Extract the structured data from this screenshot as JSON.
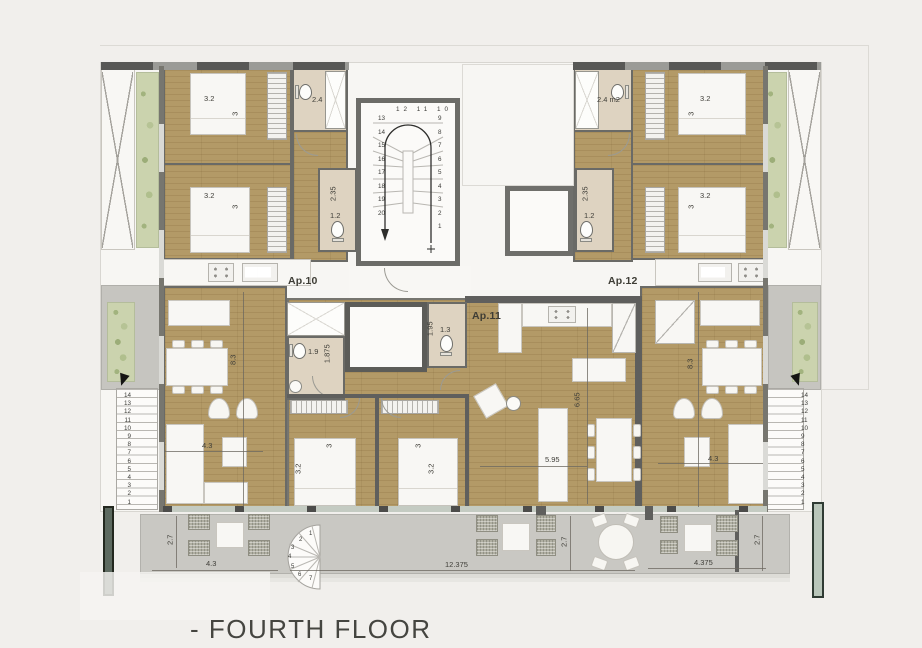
{
  "title": "- FOURTH FLOOR",
  "apartments": {
    "ap10": "Ap.10",
    "ap11": "Ap.11",
    "ap12": "Ap.12"
  },
  "dims": {
    "left_wing": {
      "bed1_w": "3.2",
      "bed1_d": "3",
      "bed2_w": "3.2",
      "bed2_d": "3",
      "bath": "2.4",
      "wc_w": "2.35",
      "wc_d": "1.2",
      "living_d": "8.3",
      "living_w": "4.3",
      "ensuite_w": "1.9",
      "ensuite_d": "1.875"
    },
    "center": {
      "wc_d": "1.95",
      "wc_w": "1.3",
      "living_d": "6.65",
      "living_w": "5.95",
      "bed_left_w": "3.2",
      "bed_left_d": "3",
      "bed_right_w": "3.2",
      "bed_right_d": "3"
    },
    "right_wing": {
      "bed1_w": "3.2",
      "bed1_d": "3",
      "bed2_w": "3.2",
      "bed2_d": "3",
      "bath": "2.4 m2",
      "wc_w": "2.35",
      "wc_d": "1.2",
      "living_d": "8.3",
      "living_w": "4.3"
    },
    "terrace": {
      "left_w": "4.3",
      "left_d": "2.7",
      "mid_w": "12.375",
      "mid_d": "2.7",
      "right_w": "4.375",
      "right_d": "2.7"
    }
  },
  "stairs": {
    "main_left": "13\n14\n15\n16\n17\n18\n19\n20",
    "main_top": "12 11 10",
    "main_right": "9\n8\n7\n6\n5\n4\n3\n2\n1",
    "side": "14\n13\n12\n11\n10\n9\n8\n7\n6\n5\n4\n3\n2\n1",
    "spiral": [
      "1",
      "2",
      "3",
      "4",
      "5",
      "6",
      "7"
    ]
  }
}
